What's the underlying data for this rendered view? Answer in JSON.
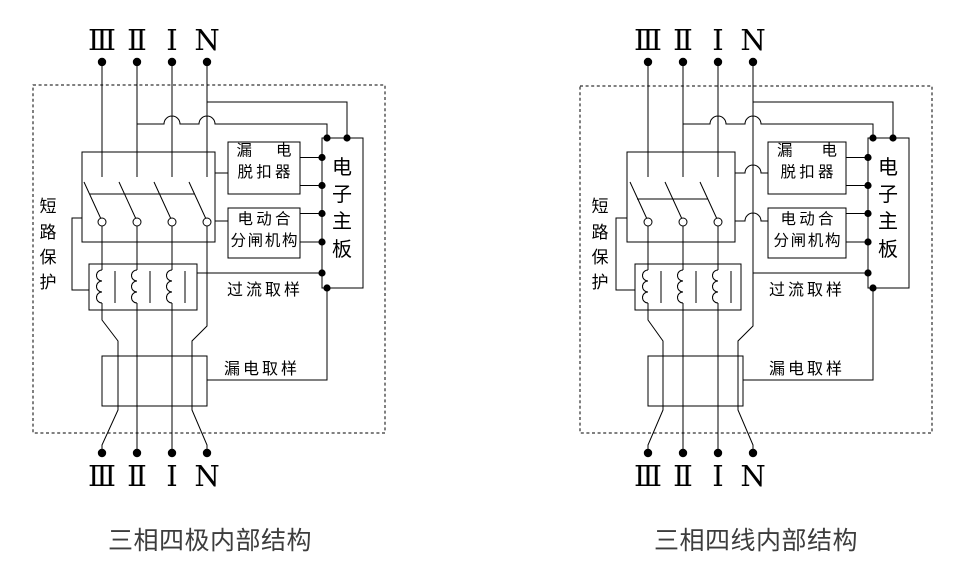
{
  "page": {
    "background": "#ffffff",
    "line_color": "#000000",
    "caption_color": "#3d3d3d"
  },
  "diagrams": [
    {
      "caption": "三相四极内部结构",
      "terminals_top": [
        "Ⅲ",
        "Ⅱ",
        "Ⅰ",
        "N"
      ],
      "terminals_bottom": [
        "Ⅲ",
        "Ⅱ",
        "Ⅰ",
        "N"
      ],
      "short_circuit_protection": [
        "短",
        "路",
        "保",
        "护"
      ],
      "leakage_tripper": [
        "漏　电",
        "脱扣器"
      ],
      "motor_mechanism": [
        "电动合",
        "分闸机构"
      ],
      "main_board": [
        "电",
        "子",
        "主",
        "板"
      ],
      "overcurrent_sampling": "过流取样",
      "leakage_sampling": "漏电取样"
    },
    {
      "caption": "三相四线内部结构",
      "terminals_top": [
        "Ⅲ",
        "Ⅱ",
        "Ⅰ",
        "N"
      ],
      "terminals_bottom": [
        "Ⅲ",
        "Ⅱ",
        "Ⅰ",
        "N"
      ],
      "short_circuit_protection": [
        "短",
        "路",
        "保",
        "护"
      ],
      "leakage_tripper": [
        "漏　电",
        "脱扣器"
      ],
      "motor_mechanism": [
        "电动合",
        "分闸机构"
      ],
      "main_board": [
        "电",
        "子",
        "主",
        "板"
      ],
      "overcurrent_sampling": "过流取样",
      "leakage_sampling": "漏电取样"
    }
  ]
}
